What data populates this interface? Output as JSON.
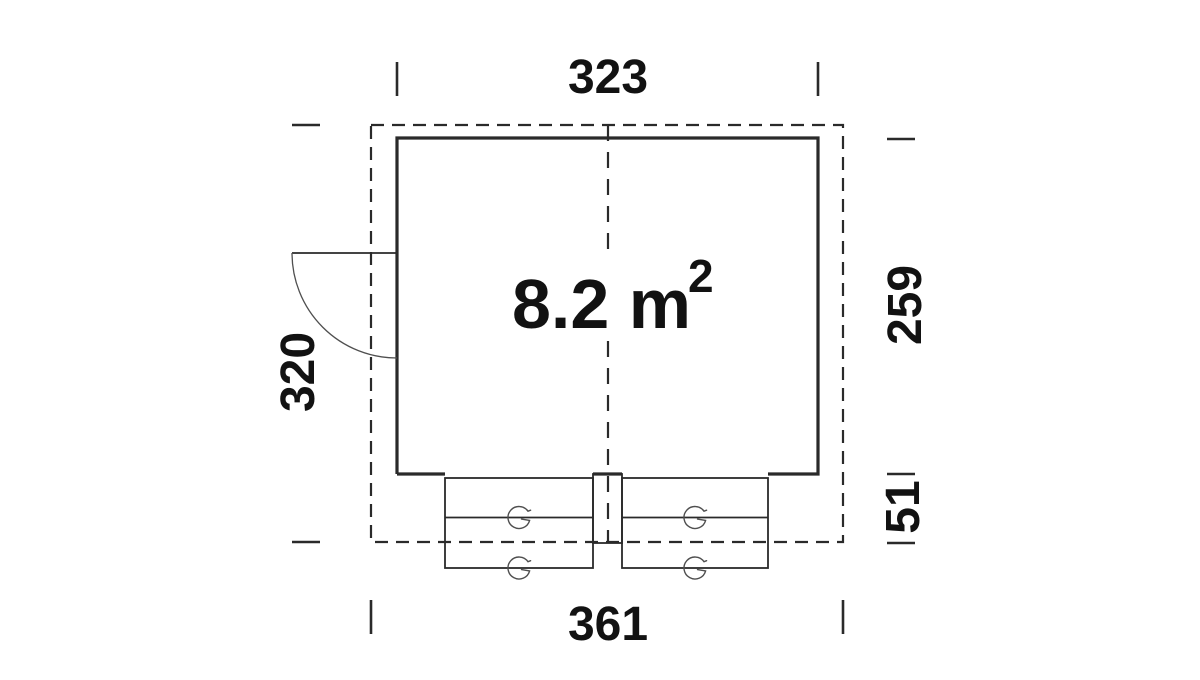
{
  "area_label": {
    "text": "8.2 m",
    "superscript": "2"
  },
  "dimensions": {
    "top_width": "323",
    "bottom_width": "361",
    "left_depth": "320",
    "right_inner_depth": "259",
    "right_flap_depth": "51"
  },
  "icons": {
    "rotation_symbol": "circular-g-arrow",
    "door_swing": "quarter-circle-arc"
  },
  "colors": {
    "line": "#2a2a2a",
    "thin_line": "#4f4f4f",
    "text": "#121212",
    "background": "#ffffff"
  }
}
